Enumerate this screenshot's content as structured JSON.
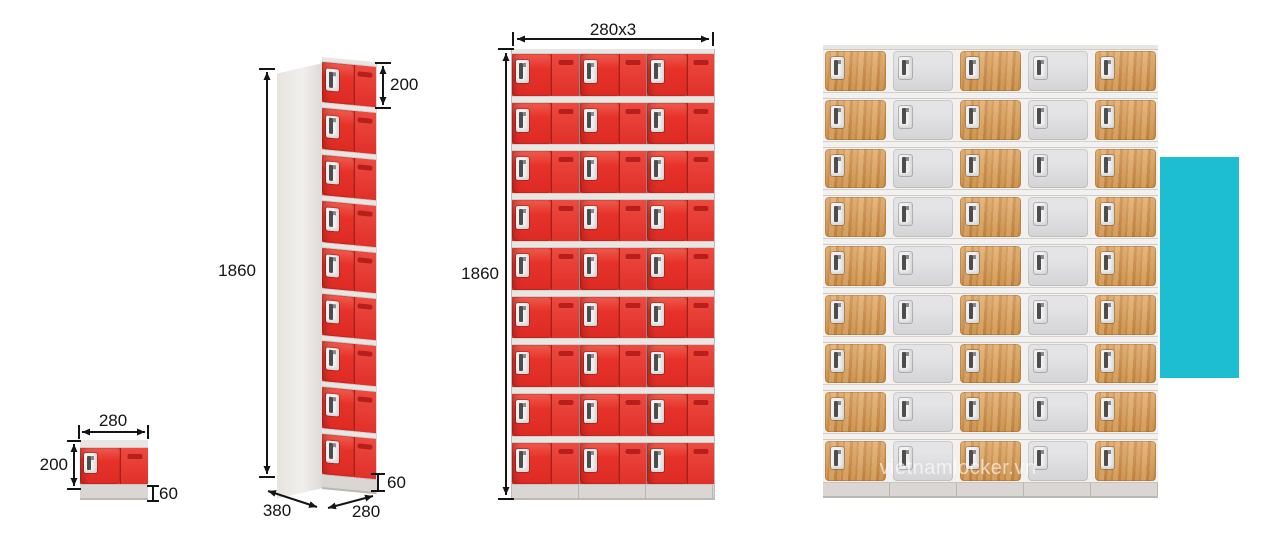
{
  "watermark": {
    "text": "vietnamlocker.vn"
  },
  "colors": {
    "red": "#e73329",
    "red_dark": "#c1251f",
    "vent": "#b5201c",
    "wood": "#d3944c",
    "gray_door": "#d8d8da",
    "frame": "#e8e6e3",
    "base": "#d9d6d3",
    "side_panel": "#edebe8",
    "cyan": "#1dbdd2",
    "dimension_text": "#141414",
    "handle_plate": "#f1f1f1",
    "handle_latch": "#4d4d4d"
  },
  "labels": {
    "small_width": "280",
    "small_height": "200",
    "small_base": "60",
    "tall_height": "1860",
    "tall_door": "200",
    "tall_base": "60",
    "tall_depth": "380",
    "tall_width": "280",
    "grid3_width": "280x3",
    "grid3_height": "1860"
  },
  "grids": {
    "small": {
      "rows": 1,
      "cols": 1,
      "pattern": [
        "red"
      ]
    },
    "tall": {
      "rows": 9,
      "cols": 1,
      "pattern": [
        "red"
      ]
    },
    "grid3": {
      "rows": 9,
      "cols": 3,
      "pattern": [
        "red",
        "red",
        "red"
      ]
    },
    "grid5": {
      "rows": 9,
      "cols": 5,
      "pattern": [
        "wood",
        "gray",
        "wood",
        "gray",
        "wood"
      ]
    }
  }
}
